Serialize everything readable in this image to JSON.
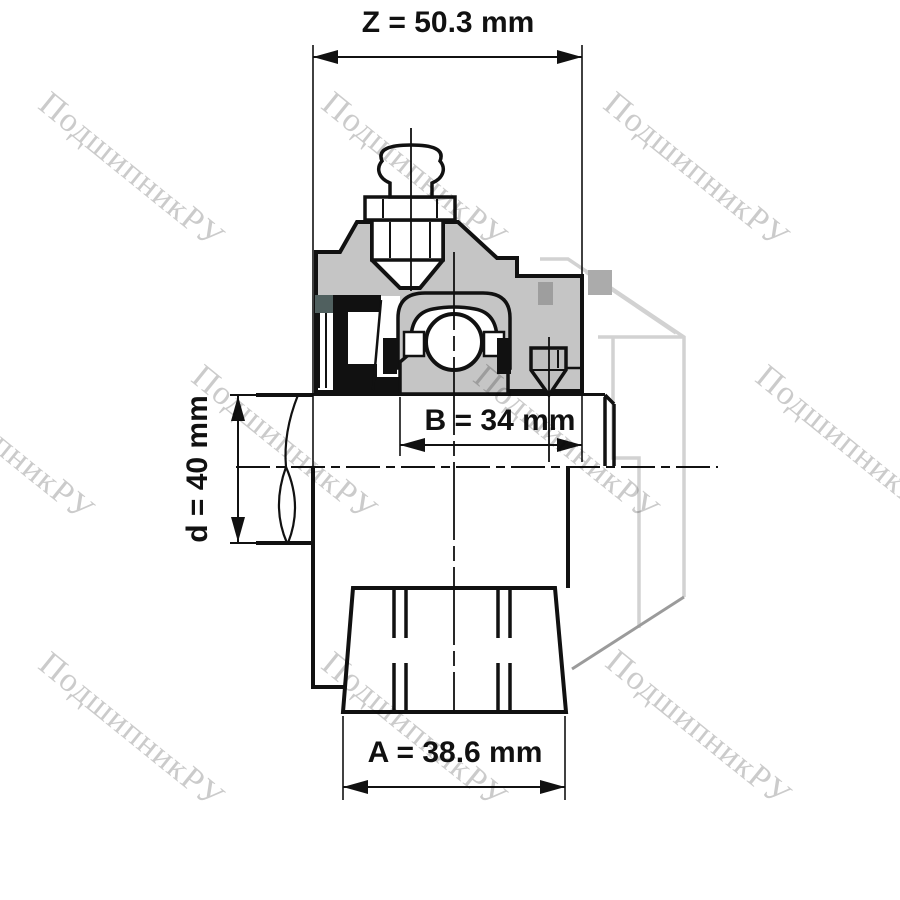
{
  "page": {
    "background": "#ffffff"
  },
  "watermark": {
    "text": "ПодшипникРУ",
    "color": "#cbcbcb",
    "angle_deg": 39
  },
  "drawing": {
    "type": "technical-drawing",
    "subject": "Flanged bearing unit cross-section with shaft, grease fitting, set screw and flange base",
    "dimensions": {
      "z": {
        "label": "Z = 50.3 mm"
      },
      "b": {
        "label": "B = 34 mm"
      },
      "d": {
        "label": "d = 40 mm"
      },
      "a": {
        "label": "A = 38.6 mm"
      }
    },
    "colors": {
      "line": "#111111",
      "housing_fill": "#c5c5c5",
      "seal_dark_fill": "#50605f",
      "phantom_outline": "#d2d2d2",
      "phantom_shadow": "#9b9b9b",
      "screw_hole_fill": "#9e9e9e",
      "phantom_hole_fill": "#ababab"
    }
  }
}
